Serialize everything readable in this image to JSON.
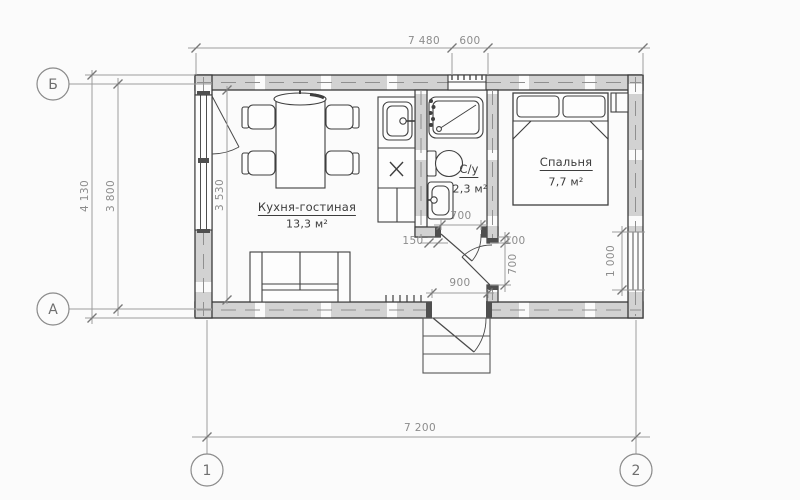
{
  "drawing": {
    "type": "floor-plan",
    "language": "ru"
  },
  "rooms": {
    "kitchen": {
      "name": "Кухня-гостиная",
      "area": "13,3 м²"
    },
    "bathroom": {
      "name": "С/у",
      "area": "2,3 м²"
    },
    "bedroom": {
      "name": "Спальня",
      "area": "7,7 м²"
    }
  },
  "dimensions": {
    "top_overall": "7 480",
    "top_window": "600",
    "left_outer": "4 130",
    "left_axes": "3 800",
    "kitchen_interior": "3 530",
    "wall_stub": "150",
    "bath_door": "700",
    "door_offset": "100",
    "bedroom_door": "700",
    "entrance_door": "900",
    "bedroom_window": "1 000",
    "bottom_axes": "7 200"
  },
  "axes": {
    "row_top": "Б",
    "row_bottom": "А",
    "col_left": "1",
    "col_right": "2"
  },
  "colors": {
    "wall_fill": "#d2d2d2",
    "outline": "#3a3a3a",
    "dimension": "#8c8c8c",
    "background": "#fbfbfb"
  }
}
